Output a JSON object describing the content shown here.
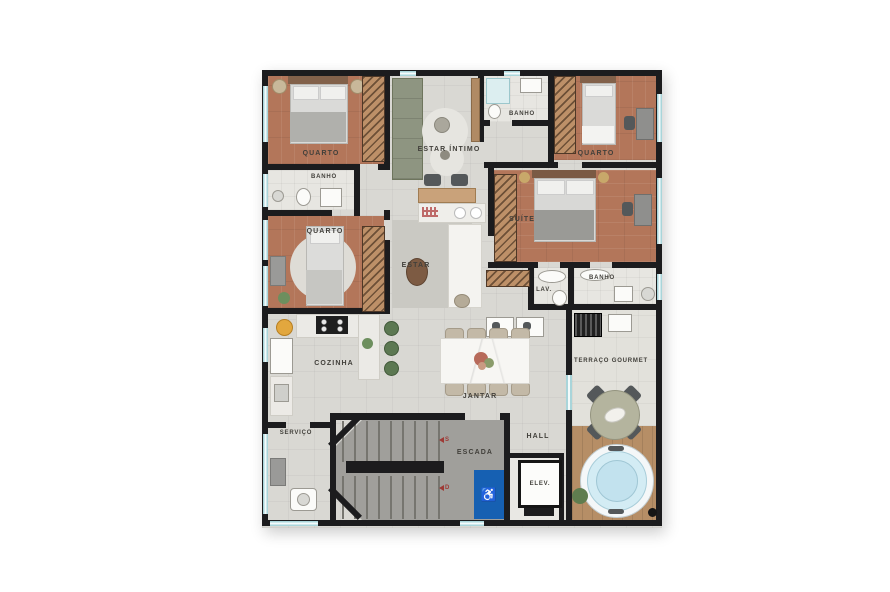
{
  "plan_title": "Apartment floor plan",
  "rooms": [
    {
      "id": "quarto-1",
      "label": "QUARTO"
    },
    {
      "id": "banho-top",
      "label": "BANHO"
    },
    {
      "id": "estar-intimo",
      "label": "ESTAR ÍNTIMO"
    },
    {
      "id": "quarto-2",
      "label": "QUARTO"
    },
    {
      "id": "banho-left",
      "label": "BANHO"
    },
    {
      "id": "quarto-3",
      "label": "QUARTO"
    },
    {
      "id": "estar",
      "label": "ESTAR"
    },
    {
      "id": "suite",
      "label": "SUÍTE"
    },
    {
      "id": "lav",
      "label": "LAV."
    },
    {
      "id": "banho-right",
      "label": "BANHO"
    },
    {
      "id": "cozinha",
      "label": "COZINHA"
    },
    {
      "id": "jantar",
      "label": "JANTAR"
    },
    {
      "id": "terraco-gourmet",
      "label": "TERRAÇO GOURMET"
    },
    {
      "id": "servico",
      "label": "SERVIÇO"
    },
    {
      "id": "hall",
      "label": "HALL"
    },
    {
      "id": "escada",
      "label": "ESCADA"
    },
    {
      "id": "elevador",
      "label": "ELEV."
    }
  ],
  "stairs": {
    "up_marker": "S",
    "down_marker": "D"
  },
  "icons": {
    "wheelchair": "♿"
  },
  "colors": {
    "wall": "#1c1c1e",
    "wood_floor": "#b3765a",
    "tile_floor": "#d9d8d3",
    "window_glass": "#a9d5da",
    "accessibility_blue": "#1660b2",
    "stair_gray": "#a09f9b",
    "deck_wood": "#b68e66",
    "tub_water": "#d3ecf4",
    "marker_red": "#9e3a36"
  }
}
